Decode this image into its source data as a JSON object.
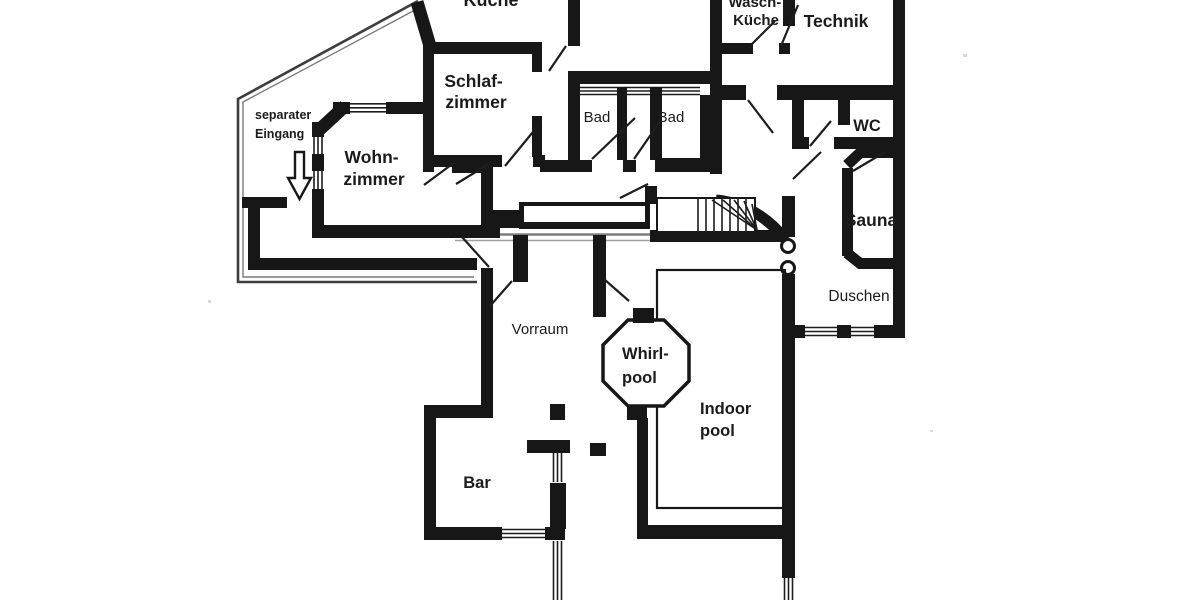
{
  "colors": {
    "ink": "#171717",
    "paper": "#ffffff",
    "boundary_line": "#3d3d3d",
    "scan_gray": "#7d7d7d"
  },
  "rooms": {
    "kueche": {
      "label": "Küche"
    },
    "schlafzimmer": {
      "line1": "Schlaf-",
      "line2": "zimmer"
    },
    "bad_left": {
      "label": "Bad"
    },
    "bad_right": {
      "label": "Bad"
    },
    "waschkueche": {
      "line1": "Wasch-",
      "line2": "Küche"
    },
    "technik": {
      "label": "Technik"
    },
    "wc": {
      "label": "WC"
    },
    "sauna": {
      "label": "Sauna"
    },
    "duschen": {
      "label": "Duschen"
    },
    "wohnzimmer": {
      "line1": "Wohn-",
      "line2": "zimmer"
    },
    "vorraum": {
      "label": "Vorraum"
    },
    "whirlpool": {
      "line1": "Whirl-",
      "line2": "pool"
    },
    "indoor_pool": {
      "line1": "Indoor",
      "line2": "pool"
    },
    "bar": {
      "label": "Bar"
    }
  },
  "annotations": {
    "separate_entrance": {
      "line1": "separater",
      "line2": "Eingang"
    }
  }
}
